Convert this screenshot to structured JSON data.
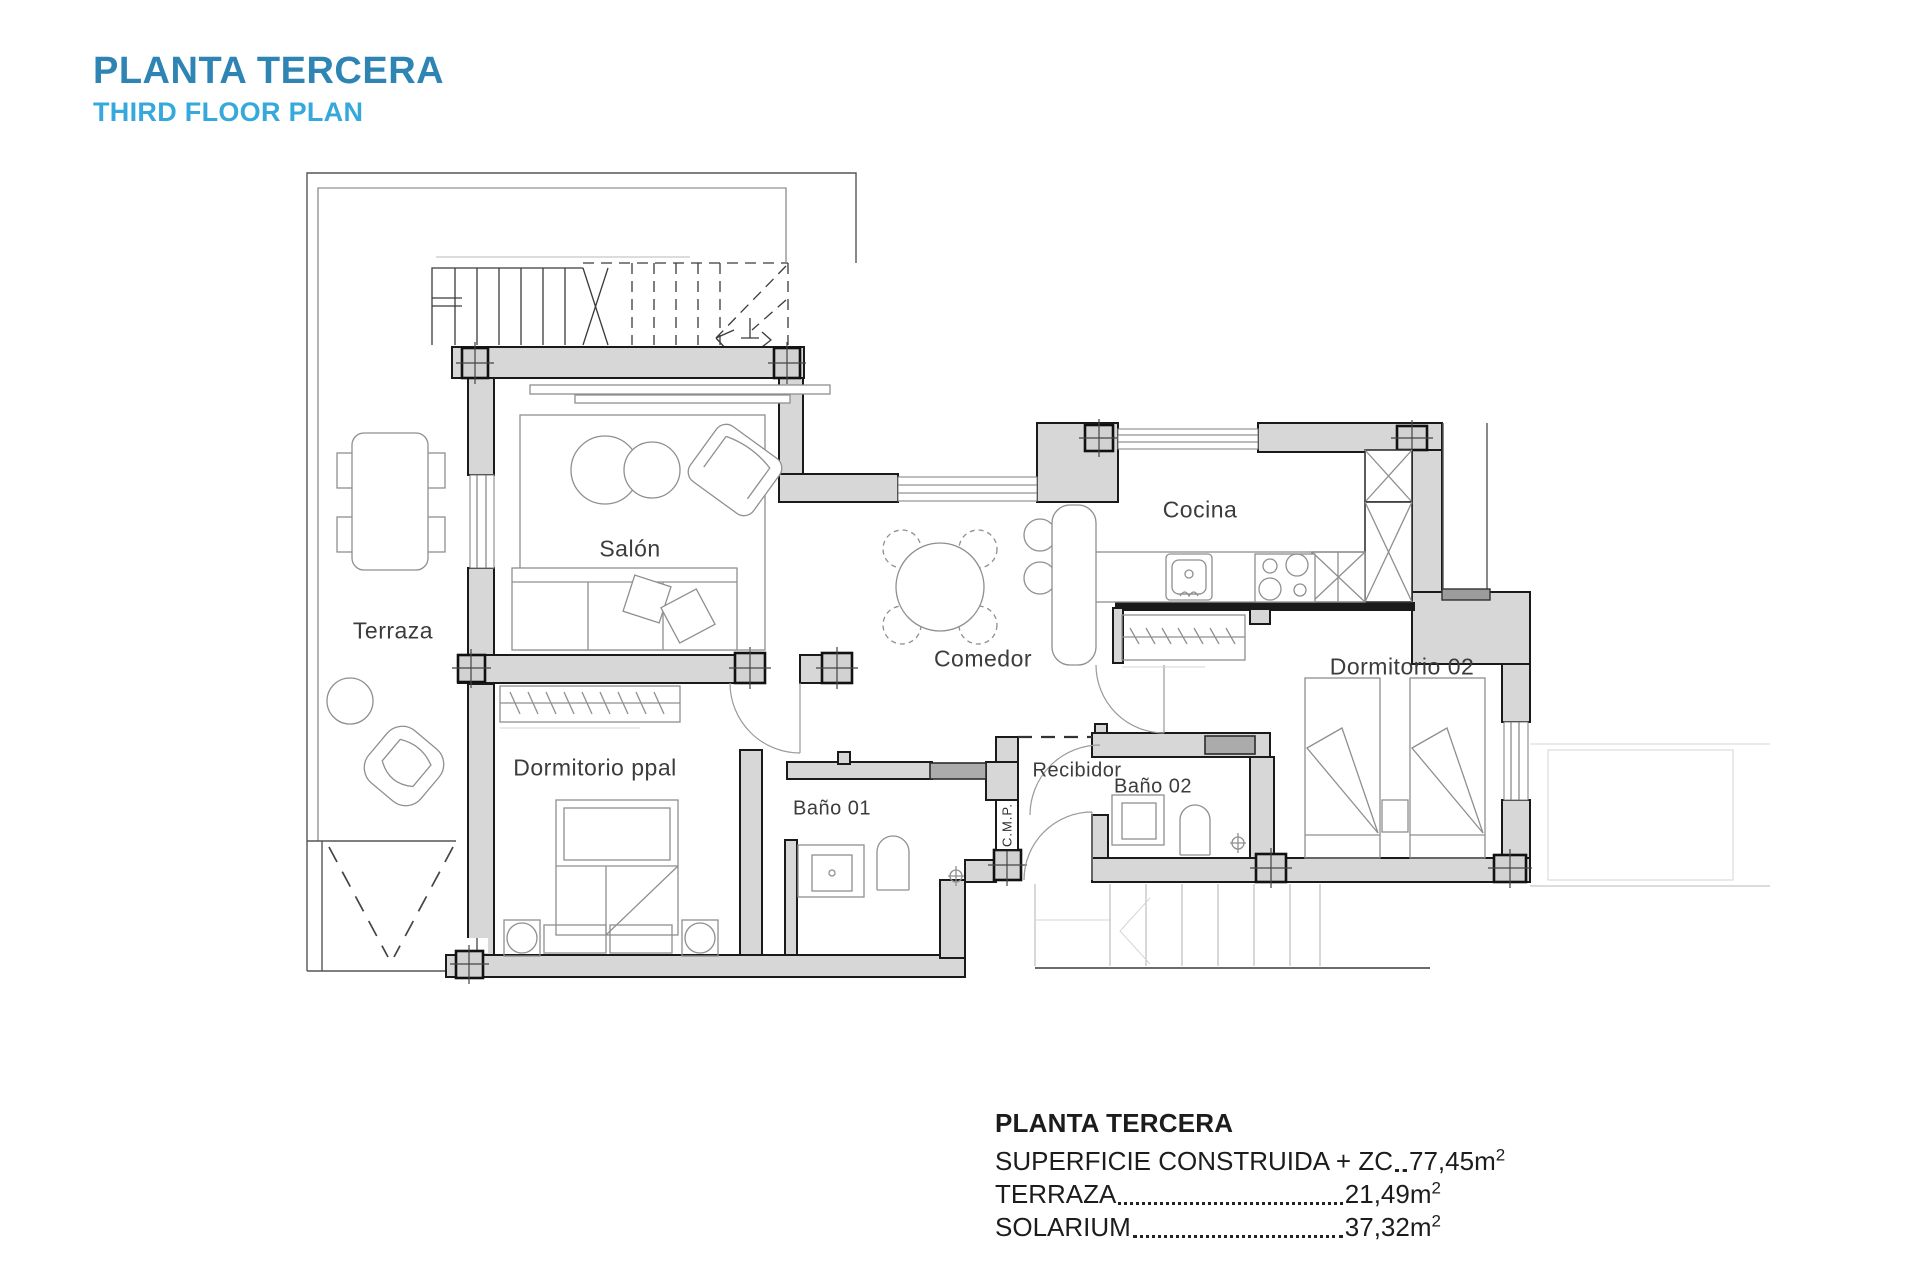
{
  "header": {
    "title": "PLANTA TERCERA",
    "subtitle": "THIRD FLOOR PLAN"
  },
  "rooms": {
    "terraza": "Terraza",
    "salon": "Salón",
    "cocina": "Cocina",
    "comedor": "Comedor",
    "dormitorio_ppal": "Dormitorio ppal",
    "bano_01": "Baño 01",
    "recibidor": "Recibidor",
    "cmp": "C.M.P.",
    "bano_02": "Baño 02",
    "dormitorio_02": "Dormitorio 02"
  },
  "legend": {
    "title": "PLANTA TERCERA",
    "rows": [
      {
        "label": "SUPERFICIE CONSTRUIDA + ZC",
        "value": "77,45",
        "unit": "m",
        "sup": "2"
      },
      {
        "label": "TERRAZA",
        "value": "21,49",
        "unit": "m",
        "sup": "2"
      },
      {
        "label": "SOLARIUM",
        "value": "37,32",
        "unit": "m",
        "sup": "2"
      }
    ]
  },
  "colors": {
    "title_primary": "#2e85b4",
    "title_secondary": "#36a9dc",
    "wall_fill": "#d7d7d7",
    "wall_line": "#1a1a1a",
    "label_color": "#3c3c3c",
    "legend_color": "#1c1c1c"
  }
}
